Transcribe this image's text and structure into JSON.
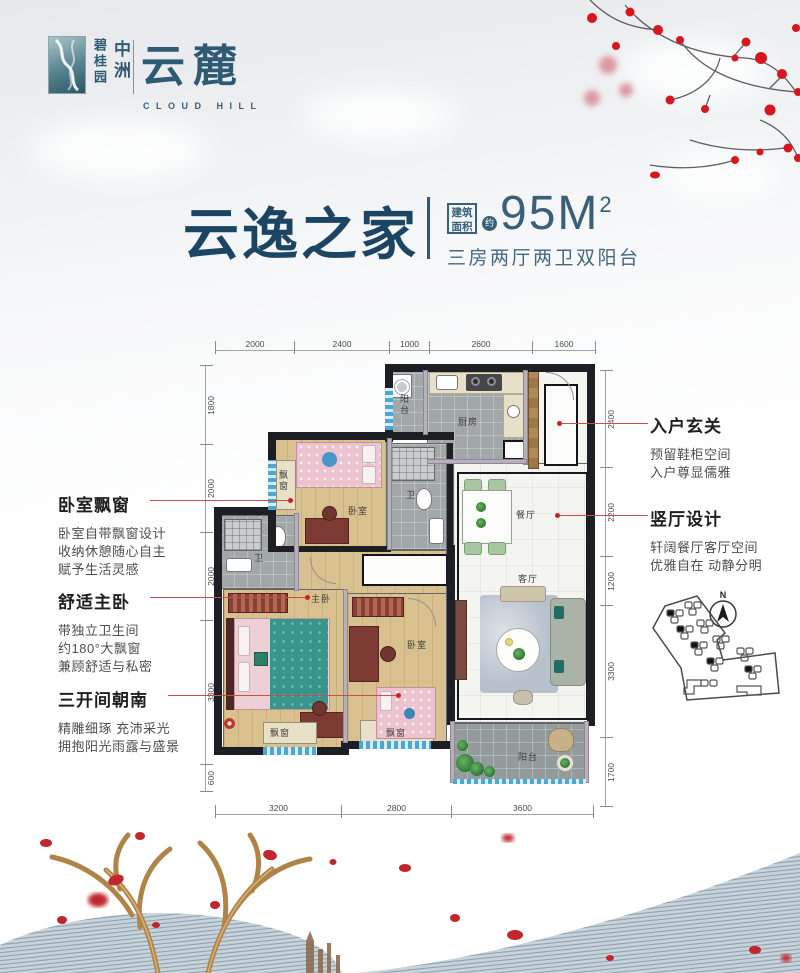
{
  "colors": {
    "brand_blue": "#2f5a74",
    "title_blue": "#1c4564",
    "accent_red": "#c0392b",
    "blossom_red": "#d8161f",
    "gold": "#b68849"
  },
  "logo": {
    "brand_col1": "碧桂园",
    "brand_col2": "中洲",
    "name": "云麓",
    "name_en": "CLOUD HILL"
  },
  "title": {
    "name": "云逸之家",
    "badge_line1": "建筑",
    "badge_line2": "面积",
    "approx": "约",
    "area_value": "95M",
    "area_sup": "2",
    "subtitle": "三房两厅两卫双阳台"
  },
  "annotations": {
    "left": [
      {
        "heading": "卧室飘窗",
        "lines": [
          "卧室自带飘窗设计",
          "收纳休憩随心自主",
          "赋予生活灵感"
        ]
      },
      {
        "heading": "舒适主卧",
        "lines": [
          "带独立卫生间",
          "约180°大飘窗",
          "兼顾舒适与私密"
        ]
      },
      {
        "heading": "三开间朝南",
        "lines": [
          "精雕细琢 充沛采光",
          "拥抱阳光雨露与盛景"
        ]
      }
    ],
    "right": [
      {
        "heading": "入户玄关",
        "lines": [
          "预留鞋柜空间",
          "入户尊显儒雅"
        ]
      },
      {
        "heading": "竖厅设计",
        "lines": [
          "轩阔餐厅客厅空间",
          "优雅自在 动静分明"
        ]
      }
    ]
  },
  "plan": {
    "rooms": {
      "balcony": "阳台",
      "kitchen": "厨房",
      "bath": "卫",
      "bedroom": "卧室",
      "bay": "飘窗",
      "master": "主卧",
      "dining": "餐厅",
      "living": "客厅"
    },
    "dims": {
      "top": [
        "2000",
        "2400",
        "1000",
        "2600",
        "1600"
      ],
      "left": [
        "1800",
        "2000",
        "2000",
        "3300",
        "600"
      ],
      "right": [
        "2400",
        "2200",
        "1200",
        "3300",
        "1700"
      ],
      "bottom": [
        "3200",
        "2800",
        "3600"
      ]
    },
    "compass": "N"
  }
}
